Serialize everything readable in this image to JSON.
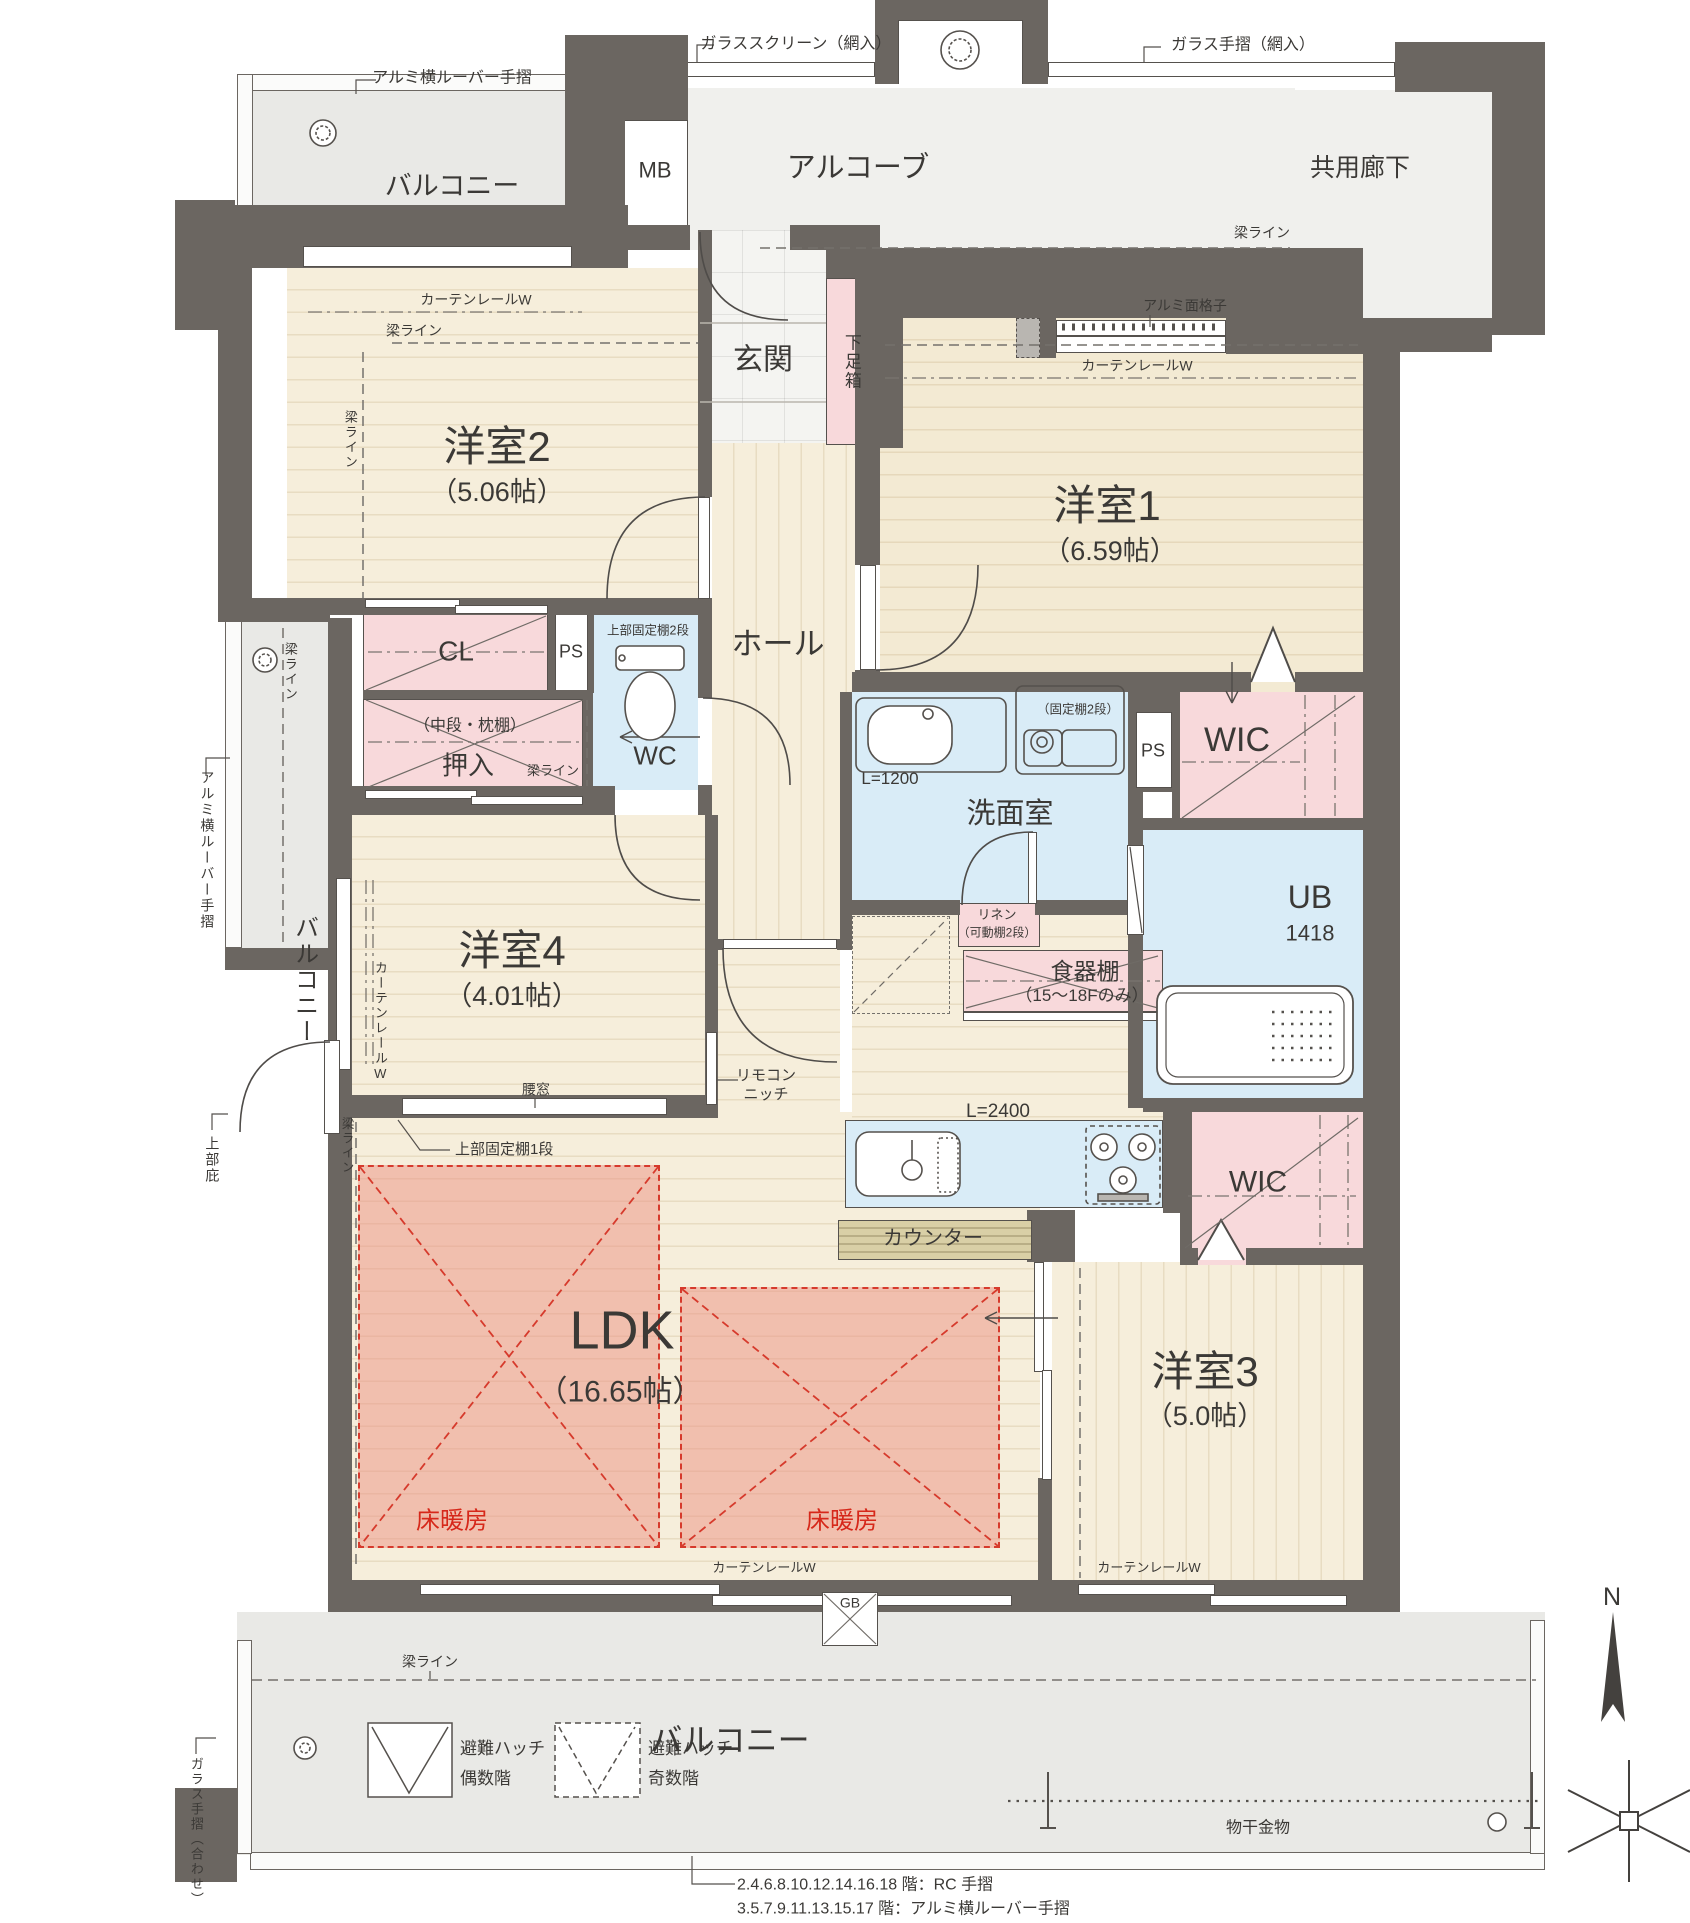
{
  "rooms": {
    "yoshitsu1": {
      "name": "洋室1",
      "size": "（6.59帖）"
    },
    "yoshitsu2": {
      "name": "洋室2",
      "size": "（5.06帖）"
    },
    "yoshitsu3": {
      "name": "洋室3",
      "size": "（5.0帖）"
    },
    "yoshitsu4": {
      "name": "洋室4",
      "size": "（4.01帖）"
    },
    "ldk": {
      "name": "LDK",
      "size": "（16.65帖）"
    },
    "hall": "ホール",
    "genkan": "玄関",
    "getabako": "下足箱",
    "senmen": "洗面室",
    "wc": "WC",
    "ub": {
      "name": "UB",
      "size": "1418"
    },
    "wic": "WIC",
    "oshiire": "押入",
    "cl": "CL",
    "ps": "PS",
    "mb": "MB",
    "alcove": "アルコーブ",
    "kyoyo_roka": "共用廊下",
    "balcony": "バルコニー",
    "shokkidana": {
      "name": "食器棚",
      "note": "（15〜18Fのみ）"
    },
    "linen": {
      "name": "リネン",
      "note": "（可動棚2段）"
    }
  },
  "ann": {
    "glass_screen": "ガラススクリーン（網入）",
    "glass_rail_ami": "ガラス手摺（網入）",
    "alumi_louver": "アルミ横ルーバー手摺",
    "alumi_mengoshi": "アルミ面格子",
    "curtain_rail": "カーテンレールW",
    "beam_line": "梁ライン",
    "jobu_kotei_2": "上部固定棚2段",
    "kotei_2": "（固定棚2段）",
    "chudan_makura": "（中段・枕棚）",
    "jobu_kotei_1": "上部固定棚1段",
    "koshimado": "腰窓",
    "remocon_1": "リモコン",
    "remocon_2": "ニッチ",
    "counter": "カウンター",
    "l1200": "L=1200",
    "l2400": "L=2400",
    "yukadanbo": "床暖房",
    "hinan_hatch": "避難ハッチ",
    "gusukai": "偶数階",
    "kisukai": "奇数階",
    "monohoshi": "物干金物",
    "gb": "GB",
    "jobu_hisashi": "上部庇",
    "glass_rail_awase": "ガラス手摺（合わせ）",
    "note_rc": "2.4.6.8.10.12.14.16.18 階：RC 手摺",
    "note_louver": "3.5.7.9.11.13.15.17 階：アルミ横ルーバー手摺",
    "compass_n": "N"
  },
  "colors": {
    "wall": "#6b6661",
    "wood": "#f6eedb",
    "closet_pink": "#f8d9db",
    "wet_blue": "#d9ecf7",
    "balcony_gray": "#e9e9e6",
    "heating_red": "#d63a2c",
    "counter_tan": "#d9cfa6"
  }
}
